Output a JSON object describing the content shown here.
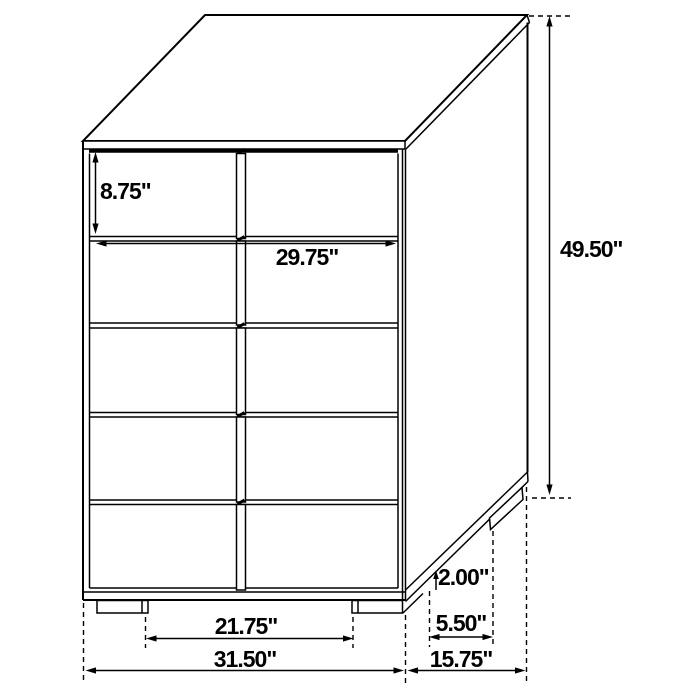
{
  "drawing": {
    "type": "furniture-dimension-diagram",
    "object": "5-drawer-chest",
    "colors": {
      "line": "#000000",
      "background": "#ffffff"
    },
    "labels": {
      "top_drawer_height": "8.75\"",
      "drawer_front_width": "29.75\"",
      "overall_height": "49.50\"",
      "base_height": "2.00\"",
      "foot_inset_depth": "5.50\"",
      "foot_span_width": "21.75\"",
      "overall_width": "31.50\"",
      "overall_depth": "15.75\""
    }
  }
}
